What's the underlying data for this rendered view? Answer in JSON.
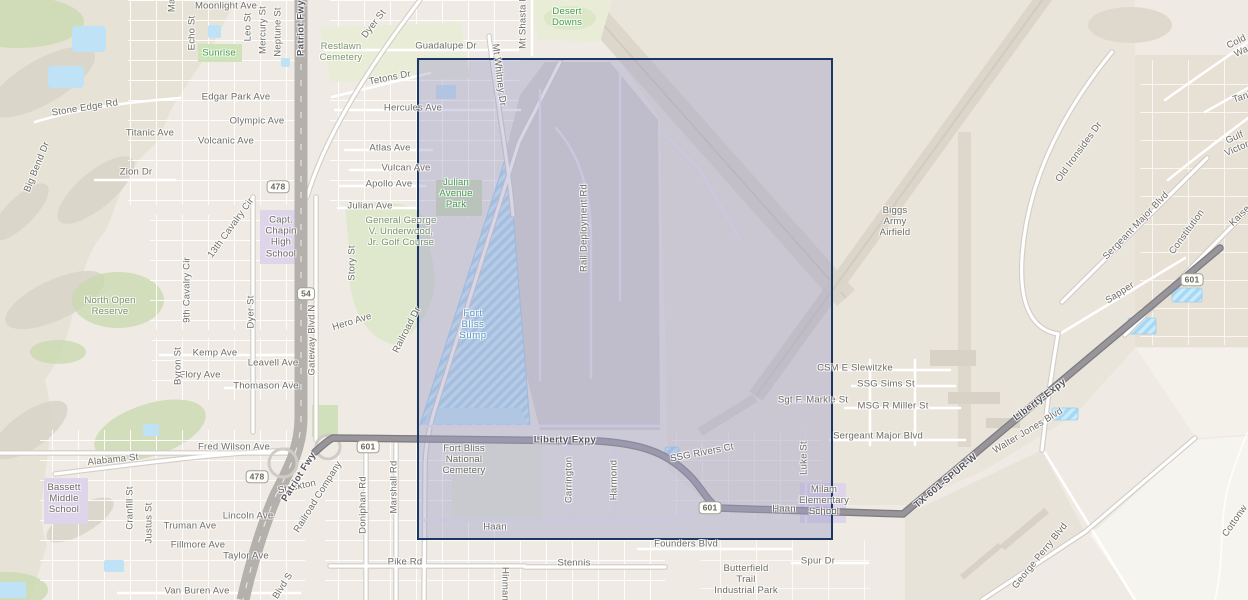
{
  "map": {
    "colors": {
      "land": "#efebe4",
      "terrain": "#e6e3d6",
      "vegetation": "#c9d8ae",
      "park": "#e9edd8",
      "water": "#bfe2f7",
      "water_hatch": "#a5d8f4",
      "school_zone": "#ded5ea",
      "airfield": "#eae5db",
      "rail_yard": "#d5d2cd",
      "freeway": "#b4b1ad",
      "expressway": "#98969b",
      "street": "#ffffff",
      "selection_fill": "rgba(157,157,197,0.42)",
      "selection_border": "#1b3764"
    },
    "selection": {
      "left": 417,
      "top": 58,
      "width": 416,
      "height": 482,
      "fill": "rgba(157,157,197,0.42)",
      "border_color": "#1b3764",
      "border_width": 2
    },
    "labels": [
      {
        "t": "Moonlight Ave",
        "x": 226,
        "y": 6,
        "r": 0,
        "c": "st"
      },
      {
        "t": "Magnetic",
        "x": 172,
        "y": -8,
        "r": -90,
        "c": "st"
      },
      {
        "t": "Echo St",
        "x": 192,
        "y": 33,
        "r": -90,
        "c": "st"
      },
      {
        "t": "Leo St",
        "x": 248,
        "y": 27,
        "r": -90,
        "c": "st"
      },
      {
        "t": "Mercury St",
        "x": 263,
        "y": 30,
        "r": -90,
        "c": "st"
      },
      {
        "t": "Neptune St",
        "x": 278,
        "y": 32,
        "r": -90,
        "c": "st"
      },
      {
        "t": "Patriot Fwy",
        "x": 301,
        "y": 28,
        "r": -90,
        "c": "hwy"
      },
      {
        "t": "Sunrise",
        "x": 219,
        "y": 53,
        "r": 0,
        "c": "grn"
      },
      {
        "t": "Edgar Park Ave",
        "x": 236,
        "y": 97,
        "r": 0,
        "c": "st"
      },
      {
        "t": "Olympic Ave",
        "x": 257,
        "y": 121,
        "r": 0,
        "c": "st"
      },
      {
        "t": "Titanic Ave",
        "x": 150,
        "y": 133,
        "r": 0,
        "c": "st"
      },
      {
        "t": "Volcanic Ave",
        "x": 226,
        "y": 141,
        "r": 0,
        "c": "st"
      },
      {
        "t": "Stone Edge Rd",
        "x": 85,
        "y": 108,
        "r": -9,
        "c": "st"
      },
      {
        "t": "Zion Dr",
        "x": 136,
        "y": 172,
        "r": 0,
        "c": "st"
      },
      {
        "t": "Big Bend Dr",
        "x": 37,
        "y": 167,
        "r": -68,
        "c": "st"
      },
      {
        "t": "478",
        "x": 278,
        "y": 187,
        "r": 0,
        "c": "shd"
      },
      {
        "t": "13th Cavalry Cir",
        "x": 231,
        "y": 228,
        "r": -54,
        "c": "st"
      },
      {
        "t": "9th Cavalry Cir",
        "x": 187,
        "y": 290,
        "r": -90,
        "c": "st"
      },
      {
        "t": "Capt.\nChapin\nHigh\nSchool",
        "x": 281,
        "y": 237,
        "r": 0,
        "c": "plc"
      },
      {
        "t": "Dyer St",
        "x": 251,
        "y": 312,
        "r": -90,
        "c": "st"
      },
      {
        "t": "Gateway Blvd N",
        "x": 312,
        "y": 340,
        "r": -90,
        "c": "st"
      },
      {
        "t": "54",
        "x": 306,
        "y": 294,
        "r": 0,
        "c": "shd"
      },
      {
        "t": "North Open\nReserve",
        "x": 110,
        "y": 306,
        "r": 0,
        "c": "sage"
      },
      {
        "t": "Kemp Ave",
        "x": 215,
        "y": 353,
        "r": 0,
        "c": "st"
      },
      {
        "t": "Leavell Ave",
        "x": 273,
        "y": 363,
        "r": 0,
        "c": "st"
      },
      {
        "t": "Flory Ave",
        "x": 200,
        "y": 375,
        "r": 0,
        "c": "st"
      },
      {
        "t": "Thomason Ave",
        "x": 266,
        "y": 386,
        "r": 0,
        "c": "st"
      },
      {
        "t": "Byron St",
        "x": 178,
        "y": 366,
        "r": -90,
        "c": "st"
      },
      {
        "t": "Fred Wilson Ave",
        "x": 234,
        "y": 447,
        "r": 0,
        "c": "st"
      },
      {
        "t": "Alabama St",
        "x": 113,
        "y": 460,
        "r": -6,
        "c": "st"
      },
      {
        "t": "478",
        "x": 257,
        "y": 477,
        "r": 0,
        "c": "shd"
      },
      {
        "t": "Stockton",
        "x": 297,
        "y": 487,
        "r": -12,
        "c": "st"
      },
      {
        "t": "Lincoln Ave",
        "x": 248,
        "y": 516,
        "r": 0,
        "c": "st"
      },
      {
        "t": "Truman Ave",
        "x": 190,
        "y": 526,
        "r": 0,
        "c": "st"
      },
      {
        "t": "Fillmore Ave",
        "x": 198,
        "y": 545,
        "r": 0,
        "c": "st"
      },
      {
        "t": "Taylor Ave",
        "x": 246,
        "y": 556,
        "r": 0,
        "c": "st"
      },
      {
        "t": "Bassett\nMiddle\nSchool",
        "x": 64,
        "y": 499,
        "r": 0,
        "c": "plc"
      },
      {
        "t": "Cranfill St",
        "x": 130,
        "y": 508,
        "r": -90,
        "c": "st"
      },
      {
        "t": "Justus St",
        "x": 149,
        "y": 523,
        "r": -90,
        "c": "st"
      },
      {
        "t": "Van Buren Ave",
        "x": 197,
        "y": 591,
        "r": 0,
        "c": "st"
      },
      {
        "t": "Patriot Fwy",
        "x": 299,
        "y": 477,
        "r": -58,
        "c": "hwy"
      },
      {
        "t": "Railroad Company",
        "x": 318,
        "y": 497,
        "r": -58,
        "c": "st"
      },
      {
        "t": "Blvd S",
        "x": 283,
        "y": 586,
        "r": -58,
        "c": "st"
      },
      {
        "t": "Doniphan Rd",
        "x": 363,
        "y": 505,
        "r": -90,
        "c": "st"
      },
      {
        "t": "Marshall Rd",
        "x": 394,
        "y": 487,
        "r": -90,
        "c": "st"
      },
      {
        "t": "601",
        "x": 368,
        "y": 447,
        "r": 0,
        "c": "shd"
      },
      {
        "t": "Pike Rd",
        "x": 405,
        "y": 562,
        "r": 0,
        "c": "st"
      },
      {
        "t": "Restlawn\nCemetery",
        "x": 341,
        "y": 52,
        "r": 0,
        "c": "sage"
      },
      {
        "t": "Dyer St",
        "x": 374,
        "y": 24,
        "r": -52,
        "c": "st"
      },
      {
        "t": "Guadalupe Dr",
        "x": 446,
        "y": 46,
        "r": 0,
        "c": "st"
      },
      {
        "t": "Desert\nDowns",
        "x": 567,
        "y": 17,
        "r": 0,
        "c": "grn"
      },
      {
        "t": "Mt Shasta Dr",
        "x": 523,
        "y": 20,
        "r": -90,
        "c": "st"
      },
      {
        "t": "Tetons Dr",
        "x": 390,
        "y": 78,
        "r": -11,
        "c": "st"
      },
      {
        "t": "Mt Whitney Dr",
        "x": 499,
        "y": 75,
        "r": 83,
        "c": "st"
      },
      {
        "t": "Hercules Ave",
        "x": 413,
        "y": 108,
        "r": 0,
        "c": "st"
      },
      {
        "t": "Atlas Ave",
        "x": 390,
        "y": 148,
        "r": 0,
        "c": "st"
      },
      {
        "t": "Vulcan Ave",
        "x": 406,
        "y": 168,
        "r": 0,
        "c": "st"
      },
      {
        "t": "Apollo Ave",
        "x": 389,
        "y": 184,
        "r": 0,
        "c": "st"
      },
      {
        "t": "Julian\nAvenue\nPark",
        "x": 456,
        "y": 194,
        "r": 0,
        "c": "grn"
      },
      {
        "t": "Julian Ave",
        "x": 370,
        "y": 206,
        "r": 0,
        "c": "st"
      },
      {
        "t": "General George\nV. Underwood,\nJr. Golf Course",
        "x": 401,
        "y": 232,
        "r": 0,
        "c": "sage"
      },
      {
        "t": "Story St",
        "x": 352,
        "y": 263,
        "r": -90,
        "c": "st"
      },
      {
        "t": "Hero Ave",
        "x": 352,
        "y": 322,
        "r": -17,
        "c": "st"
      },
      {
        "t": "Railroad Dr",
        "x": 407,
        "y": 330,
        "r": -63,
        "c": "st"
      },
      {
        "t": "Fort\nBliss\nSump",
        "x": 473,
        "y": 325,
        "r": 0,
        "c": "wat"
      },
      {
        "t": "Rail Deployment Rd",
        "x": 584,
        "y": 228,
        "r": -90,
        "c": "st"
      },
      {
        "t": "Biggs\nArmy\nAirfield",
        "x": 895,
        "y": 222,
        "r": 0,
        "c": "plc"
      },
      {
        "t": "Liberty Expy",
        "x": 565,
        "y": 440,
        "r": 0,
        "c": "hwy"
      },
      {
        "t": "Fort Bliss\nNational\nCemetery",
        "x": 464,
        "y": 460,
        "r": 0,
        "c": "plc"
      },
      {
        "t": "Carrington",
        "x": 569,
        "y": 480,
        "r": -90,
        "c": "st"
      },
      {
        "t": "Harmond",
        "x": 614,
        "y": 480,
        "r": -90,
        "c": "st"
      },
      {
        "t": "Haan",
        "x": 495,
        "y": 527,
        "r": 0,
        "c": "st"
      },
      {
        "t": "SSG Rivers Ct",
        "x": 702,
        "y": 453,
        "r": -11,
        "c": "st"
      },
      {
        "t": "Luke St",
        "x": 804,
        "y": 458,
        "r": -90,
        "c": "st"
      },
      {
        "t": "601",
        "x": 710,
        "y": 508,
        "r": 0,
        "c": "shd"
      },
      {
        "t": "Haan",
        "x": 784,
        "y": 509,
        "r": 0,
        "c": "st"
      },
      {
        "t": "Milam\nElementary\nSchool",
        "x": 824,
        "y": 501,
        "r": 0,
        "c": "plc"
      },
      {
        "t": "Founders Blvd",
        "x": 686,
        "y": 544,
        "r": 0,
        "c": "st"
      },
      {
        "t": "Stennis",
        "x": 574,
        "y": 563,
        "r": 0,
        "c": "st"
      },
      {
        "t": "Hinman",
        "x": 505,
        "y": 584,
        "r": 90,
        "c": "st"
      },
      {
        "t": "Spur Dr",
        "x": 818,
        "y": 561,
        "r": 0,
        "c": "st"
      },
      {
        "t": "Butterfield\nTrail\nIndustrial Park",
        "x": 746,
        "y": 580,
        "r": 0,
        "c": "plc"
      },
      {
        "t": "Sgt F. Markle St",
        "x": 813,
        "y": 400,
        "r": 0,
        "c": "st"
      },
      {
        "t": "CSM E Slewitzke",
        "x": 855,
        "y": 368,
        "r": 0,
        "c": "st"
      },
      {
        "t": "SSG Sims St",
        "x": 886,
        "y": 384,
        "r": 0,
        "c": "st"
      },
      {
        "t": "MSG R Miller St",
        "x": 893,
        "y": 406,
        "r": 0,
        "c": "st"
      },
      {
        "t": "Sergeant Major Blvd",
        "x": 878,
        "y": 436,
        "r": 0,
        "c": "st"
      },
      {
        "t": "Old Ironsides Dr",
        "x": 1079,
        "y": 152,
        "r": -54,
        "c": "st"
      },
      {
        "t": "Cold Wa",
        "x": 1239,
        "y": 47,
        "r": -26,
        "c": "st"
      },
      {
        "t": "Tank",
        "x": 1243,
        "y": 97,
        "r": -18,
        "c": "st"
      },
      {
        "t": "Gulf Victory",
        "x": 1237,
        "y": 143,
        "r": -24,
        "c": "st"
      },
      {
        "t": "Kaise",
        "x": 1240,
        "y": 216,
        "r": -45,
        "c": "st"
      },
      {
        "t": "Sergeant Major Blvd",
        "x": 1136,
        "y": 226,
        "r": -46,
        "c": "st"
      },
      {
        "t": "Constitution",
        "x": 1187,
        "y": 232,
        "r": -54,
        "c": "st"
      },
      {
        "t": "Sapper",
        "x": 1120,
        "y": 293,
        "r": -33,
        "c": "st"
      },
      {
        "t": "601",
        "x": 1192,
        "y": 280,
        "r": 0,
        "c": "shd"
      },
      {
        "t": "Liberty-Expy",
        "x": 1040,
        "y": 400,
        "r": -37,
        "c": "hwy"
      },
      {
        "t": "Walter Jones Blvd",
        "x": 1028,
        "y": 431,
        "r": -31,
        "c": "st"
      },
      {
        "t": "TX-601-SPUR-W",
        "x": 946,
        "y": 481,
        "r": -40,
        "c": "hwy"
      },
      {
        "t": "George Perry Blvd",
        "x": 1040,
        "y": 556,
        "r": -51,
        "c": "st"
      },
      {
        "t": "Cottonw",
        "x": 1235,
        "y": 521,
        "r": -55,
        "c": "st"
      }
    ]
  }
}
